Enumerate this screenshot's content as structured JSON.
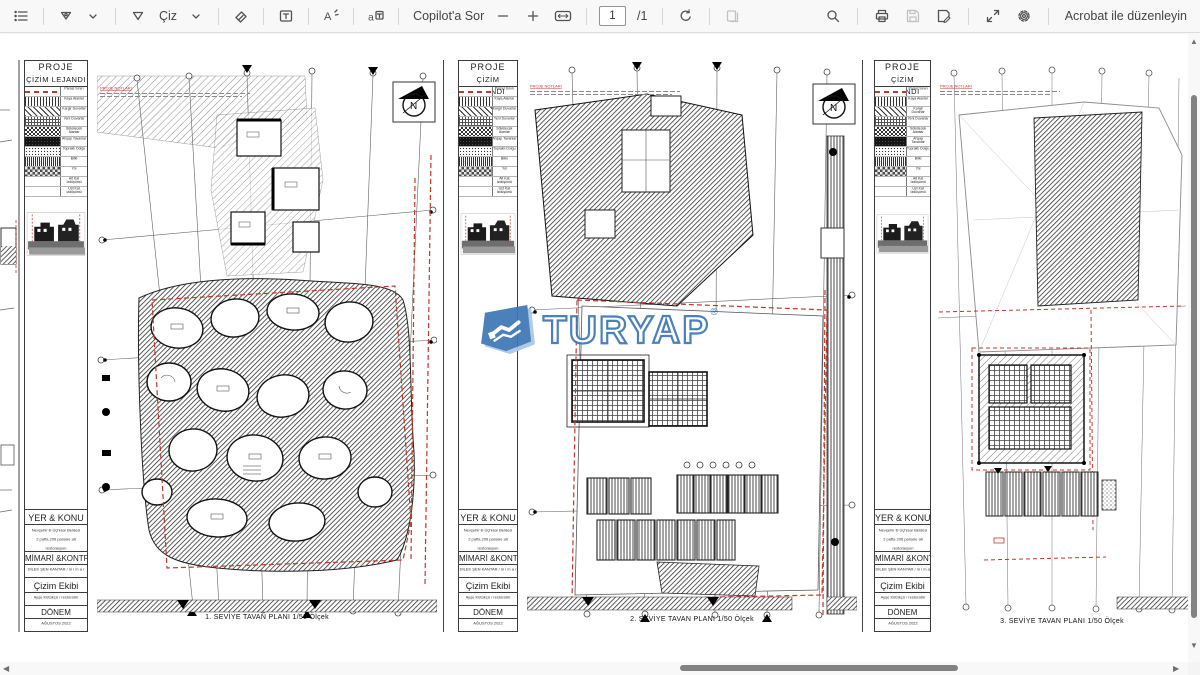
{
  "toolbar": {
    "draw_label": "Çiz",
    "ask_copilot": "Copilot'a Sor",
    "page_number": "1",
    "page_total": "/1",
    "edit_in_acrobat": "Acrobat ile düzenleyin"
  },
  "watermark": {
    "text": "TURYAP",
    "reg": "®",
    "color": "#3f77b5"
  },
  "titleblock": {
    "project_header": "PROJE",
    "legend_header": "ÇİZİM LEJANDI",
    "legend": [
      {
        "label": "Parsel Sınırı",
        "pattern": "red-dash"
      },
      {
        "label": "Kaya Alanlar",
        "pattern": "vlines"
      },
      {
        "label": "Kargir Duvarlar",
        "pattern": "diag"
      },
      {
        "label": "Yeni Duvarlar",
        "pattern": "grid"
      },
      {
        "label": "Sökülecek Alanlar",
        "pattern": "checker"
      },
      {
        "label": "Ahşap Tavanlar",
        "pattern": "dark"
      },
      {
        "label": "Topraklı Dolgu",
        "pattern": "stipple"
      },
      {
        "label": "Bitki",
        "pattern": "vlines2"
      },
      {
        "label": "Yol",
        "pattern": "checker2"
      },
      {
        "label": "Alt Kat İzdüşümü",
        "pattern": "blank"
      },
      {
        "label": "Üst Kat İzdüşümü",
        "pattern": "blank"
      }
    ],
    "notes_title": "PROJE NOTLARI",
    "location_header": "YER & KONU",
    "location_lines": [
      "Nevşehir ili Üçhisar Beldesi",
      "2 pafta 206 parsele ait",
      "restorasyon"
    ],
    "architect_header": "MİMARİ &KONTROL",
    "architect_line": "DİLEK ŞEN KANTAR / m i m a r",
    "team_header": "Çizim Ekibi",
    "team_line": "Ayşe Kütükçü / restoratör",
    "period_header": "DÖNEM",
    "period_line": "AĞUSTOS 2022"
  },
  "sheets": [
    {
      "caption": "1. SEVİYE TAVAN PLANI 1/50  Ölçek"
    },
    {
      "caption": "2. SEVİYE TAVAN PLANI 1/50  Ölçek"
    },
    {
      "caption": "3. SEVİYE TAVAN PLANI 1/50  Ölçek"
    }
  ]
}
